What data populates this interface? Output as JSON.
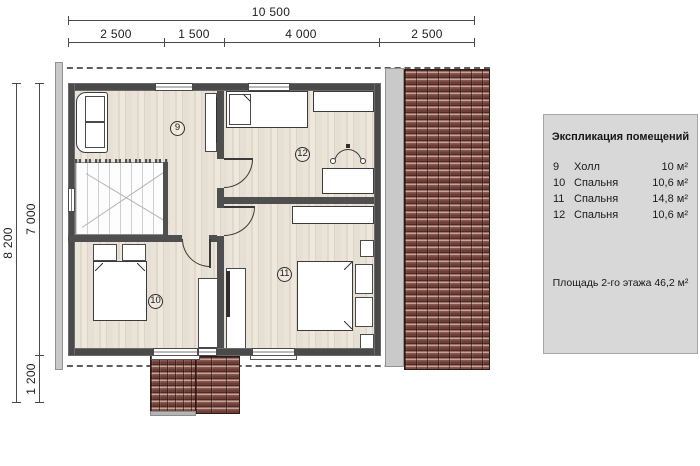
{
  "dimensions": {
    "top_total": "10 500",
    "top_segments": [
      "2 500",
      "1 500",
      "4 000",
      "2 500"
    ],
    "left_total": "8 200",
    "left_segments": [
      "7 000",
      "1 200"
    ]
  },
  "legend": {
    "title": "Экспликация помещений",
    "rows": [
      {
        "num": "9",
        "name": "Холл",
        "area": "10 м²"
      },
      {
        "num": "10",
        "name": "Спальня",
        "area": "10,6 м²"
      },
      {
        "num": "11",
        "name": "Спальня",
        "area": "14,8 м²"
      },
      {
        "num": "12",
        "name": "Спальня",
        "area": "10,6 м²"
      }
    ],
    "footer": "Площадь 2-го этажа 46,2 м²"
  },
  "rooms": [
    {
      "number": "9"
    },
    {
      "number": "10"
    },
    {
      "number": "11"
    },
    {
      "number": "12"
    }
  ],
  "colors": {
    "wall": "#4f4f4f",
    "floor": "#e7e0d5",
    "roof_tile": "#7a4a42",
    "legend_panel": "#d8d8d8"
  }
}
